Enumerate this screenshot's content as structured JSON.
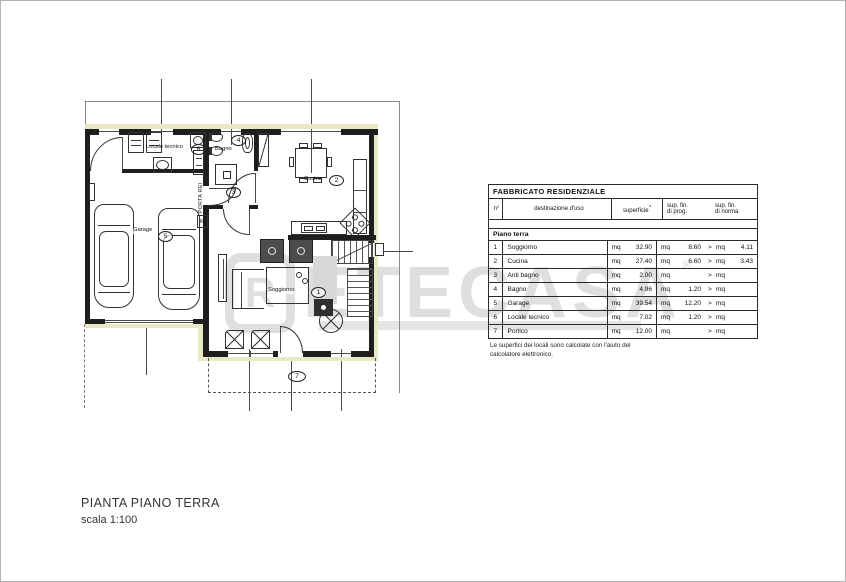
{
  "watermark": {
    "logo_letter": "R",
    "text": "ETECASA",
    "registered": "®"
  },
  "plan": {
    "rooms": {
      "soggiorno": {
        "num": "1",
        "label": "Soggiorno"
      },
      "cucina": {
        "num": "2",
        "label": "Cucina"
      },
      "antibagno": {
        "num": "3",
        "label": ""
      },
      "bagno": {
        "num": "4",
        "label": "Bagno"
      },
      "garage": {
        "num": "5",
        "label": "Garage"
      },
      "locale_tecnico": {
        "num": "6",
        "label": "Locale tecnico"
      },
      "portico": {
        "num": "7",
        "label": ""
      }
    },
    "fire_door": {
      "label": "PORTA REI",
      "rating": "60"
    }
  },
  "table": {
    "title": "FABBRICATO RESIDENZIALE",
    "headers": {
      "num": "n°",
      "use": "destinazione d'uso",
      "surface": "superficie",
      "surface_mark": "*",
      "prog_line1": "sup. fin.",
      "prog_line2": "di prog.",
      "norma_line1": "sup. fin.",
      "norma_line2": "di norma"
    },
    "section": "Piano terra",
    "unit": "mq",
    "gt": ">",
    "rows": [
      {
        "n": "1",
        "use": "Soggiorno",
        "sup": "32.90",
        "prog": "8.60",
        "norma": "4.11"
      },
      {
        "n": "2",
        "use": "Cucina",
        "sup": "27.40",
        "prog": "6.60",
        "norma": "3.43"
      },
      {
        "n": "3",
        "use": "Anti bagno",
        "sup": "2.00",
        "prog": "",
        "norma": ""
      },
      {
        "n": "4",
        "use": "Bagno",
        "sup": "4.96",
        "prog": "1.20",
        "norma": ""
      },
      {
        "n": "5",
        "use": "Garage",
        "sup": "39.54",
        "prog": "12.20",
        "norma": ""
      },
      {
        "n": "6",
        "use": "Locale tecnico",
        "sup": "7.02",
        "prog": "1.20",
        "norma": ""
      },
      {
        "n": "7",
        "use": "Portico",
        "sup": "12.00",
        "prog": "",
        "norma": ""
      }
    ],
    "footnote": "Le superfici dei locali sono calcolate con l'aiuto del calcolatore elettronico."
  },
  "caption": {
    "title": "PIANTA PIANO TERRA",
    "scale": "scala 1:100"
  }
}
